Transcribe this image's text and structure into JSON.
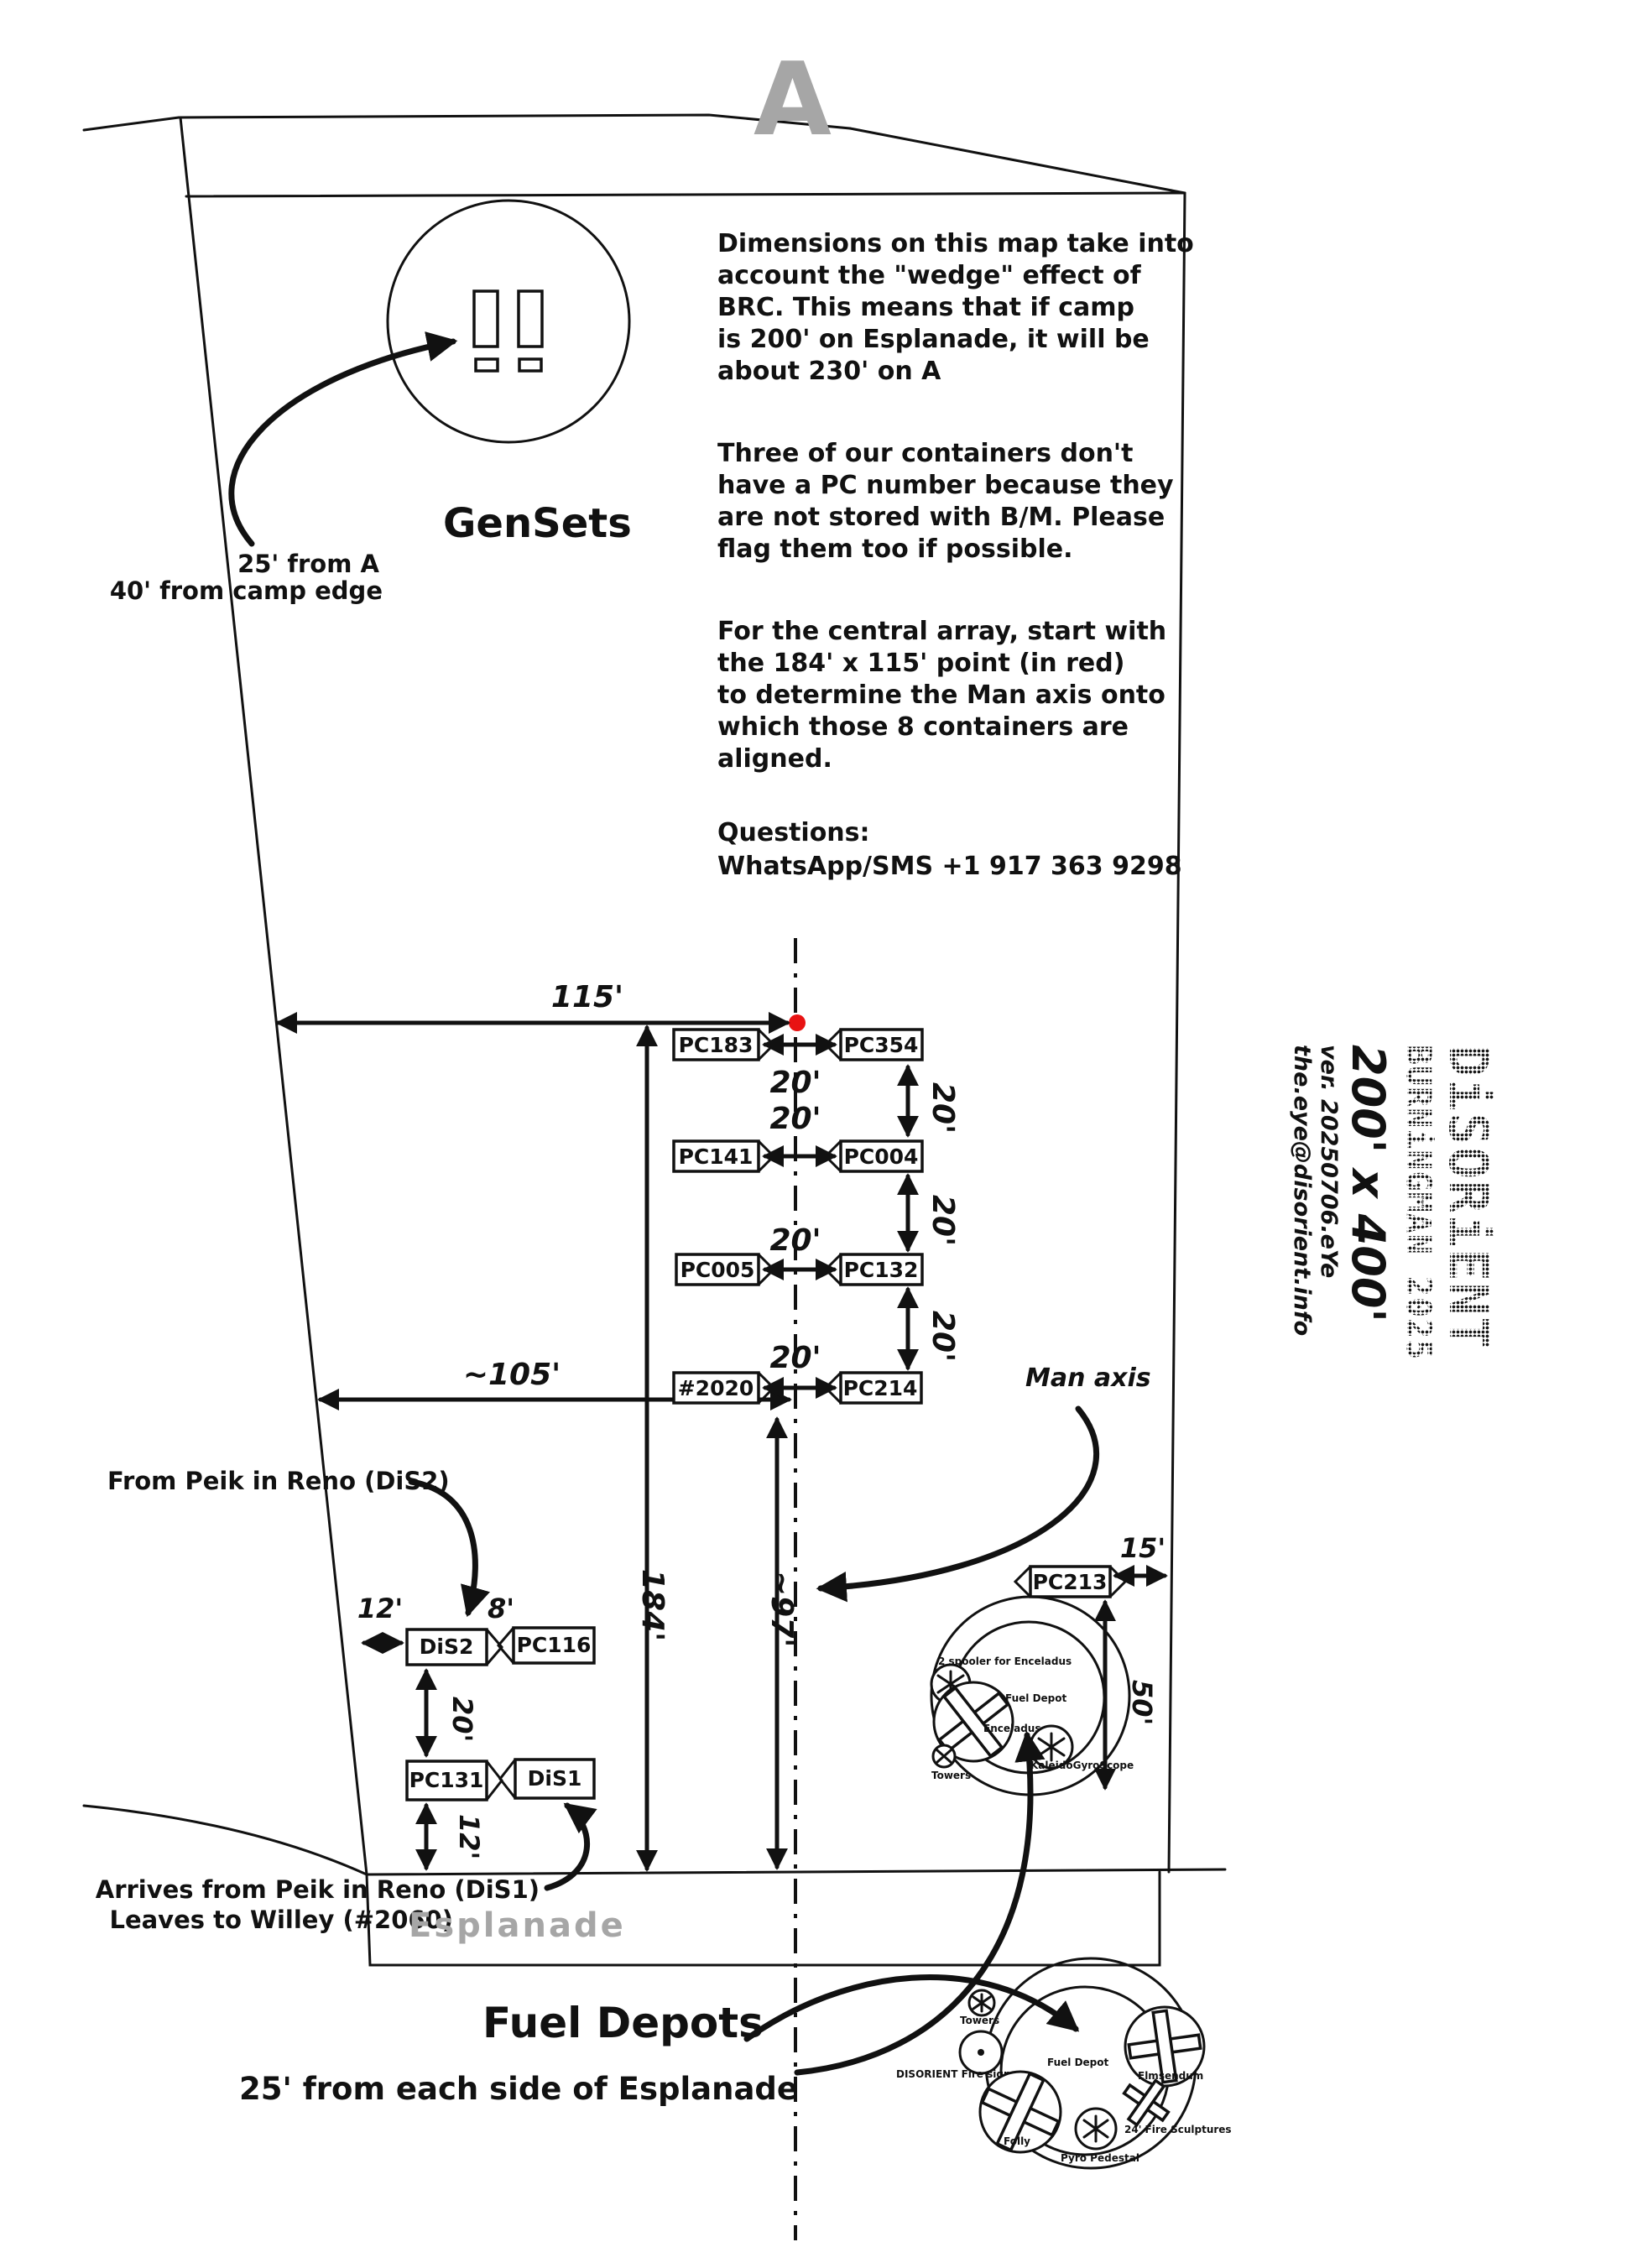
{
  "street_letter": "A",
  "gensets": {
    "title": "GenSets",
    "line1": "25' from A",
    "line2": "40' from camp edge"
  },
  "notes": {
    "p1": [
      "Dimensions on this map take into",
      "account the \"wedge\" effect of",
      "BRC. This means that if camp",
      "is 200' on Esplanade, it will be",
      "about 230' on A"
    ],
    "p2": [
      "Three of our containers don't",
      "have a PC number because they",
      "are not stored with B/M. Please",
      "flag them too if possible."
    ],
    "p3": [
      "For the central array, start with",
      "the 184' x 115' point (in red)",
      "to determine the Man axis onto",
      "which those 8 containers are",
      "aligned."
    ],
    "p4": [
      "Questions:",
      "WhatsApp/SMS +1 917 363 9298"
    ]
  },
  "dims": {
    "d115": "115'",
    "d184": "184'",
    "d105": "~105'",
    "d97": "~97'",
    "d20": "20'",
    "d12": "12'",
    "d8": "8'",
    "d15": "15'",
    "d50": "50'"
  },
  "containers": {
    "pc183": "PC183",
    "pc354": "PC354",
    "pc141": "PC141",
    "pc004": "PC004",
    "pc005": "PC005",
    "pc132": "PC132",
    "n2020": "#2020",
    "pc214": "PC214",
    "dis2": "DiS2",
    "pc116": "PC116",
    "pc131": "PC131",
    "dis1": "DiS1",
    "pc213": "PC213"
  },
  "man_axis_label": "Man axis",
  "left_notes": {
    "from_peik": "From Peik in Reno (DiS2)",
    "arrives1": "Arrives from Peik in Reno (DiS1)",
    "arrives2": "Leaves to Willey (#2060)"
  },
  "esplanade_label": "Esplanade",
  "fuel": {
    "title": "Fuel Depots",
    "subtitle": "25' from each side of Esplanade"
  },
  "depot_top": {
    "spooler": "2 spooler for Enceladus",
    "fuel_depot": "Fuel Depot",
    "enceladus": "Enceladus",
    "kaleido": "KaleidoGyroScope",
    "towers": "Towers"
  },
  "depot_bottom": {
    "towers": "Towers",
    "fire_sign": "DISORIENT Fire sign",
    "fuel_depot": "Fuel Depot",
    "elmsendum": "Elmsendum",
    "folly": "Folly",
    "pyro": "Pyro Pedestal",
    "sculptures": "24' Fire Sculptures"
  },
  "logo": {
    "brand": "DiSORiENT",
    "event": "BURNiNGMAN 2025",
    "size": "200' x 400'",
    "version": "ver. 20250706.eYe",
    "email": "the.eye@disorient.info"
  },
  "colors": {
    "red_point": "#e81313",
    "ink": "#111111",
    "gray": "#a6a6a6"
  }
}
